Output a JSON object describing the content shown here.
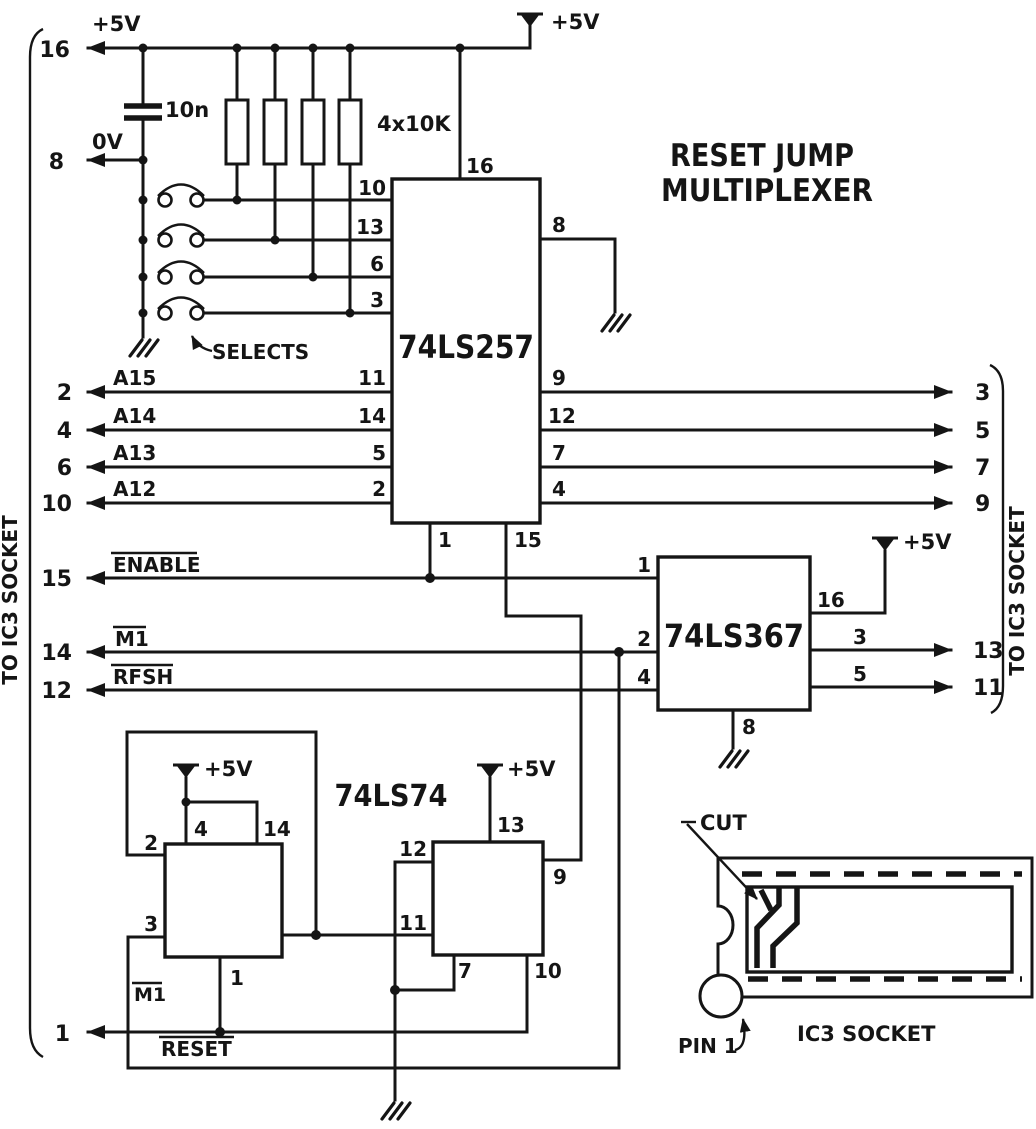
{
  "title": {
    "line1": "RESET JUMP",
    "line2": "MULTIPLEXER"
  },
  "brackets": {
    "left_label": "TO IC3 SOCKET",
    "right_label": "TO IC3 SOCKET"
  },
  "power": {
    "vcc_left": "+5V",
    "vcc_top": "+5V",
    "vcc_367": "+5V",
    "vcc_ff1": "+5V",
    "vcc_ff2": "+5V",
    "zero_v": "0V",
    "cap_value": "10n",
    "resistor_value": "4x10K"
  },
  "annotations": {
    "selects": "SELECTS",
    "cut": "CUT",
    "pin1": "PIN 1",
    "socket_caption": "IC3 SOCKET"
  },
  "left_pins": {
    "vcc": "16",
    "gnd": "8",
    "a15": "2",
    "a14": "4",
    "a13": "6",
    "a12": "10",
    "enable": "15",
    "m1": "14",
    "rfsh": "12",
    "reset": "1"
  },
  "right_pins": {
    "a15": "3",
    "a14": "5",
    "a13": "7",
    "a12": "9",
    "m1": "13",
    "rfsh": "11"
  },
  "signals": {
    "a15": "A15",
    "a14": "A14",
    "a13": "A13",
    "a12": "A12",
    "enable": "ENABLE",
    "m1": "M1",
    "rfsh": "RFSH",
    "reset": "RESET"
  },
  "ls257": {
    "name": "74LS257",
    "pin_vcc": "16",
    "pin_gnd": "8",
    "select_inputs": [
      "10",
      "13",
      "6",
      "3"
    ],
    "a_inputs": [
      "11",
      "14",
      "5",
      "2"
    ],
    "outputs": [
      "9",
      "12",
      "7",
      "4"
    ],
    "pin_enable": "1",
    "pin_select": "15"
  },
  "ls367": {
    "name": "74LS367",
    "pin_en": "1",
    "pin_in1": "2",
    "pin_in2": "4",
    "pin_vcc": "16",
    "pin_out1": "3",
    "pin_out2": "5",
    "pin_gnd": "8"
  },
  "ls74": {
    "name": "74LS74",
    "clk_label": "M1",
    "ff1": {
      "pin_pr": "4",
      "pin_vcc": "14",
      "pin_d": "2",
      "pin_clk": "3",
      "pin_clr": "1"
    },
    "ff2": {
      "pin_vcc": "13",
      "pin_d": "12",
      "pin_clk": "11",
      "pin_q": "9",
      "pin_gnd": "7",
      "pin_pr": "10"
    }
  }
}
